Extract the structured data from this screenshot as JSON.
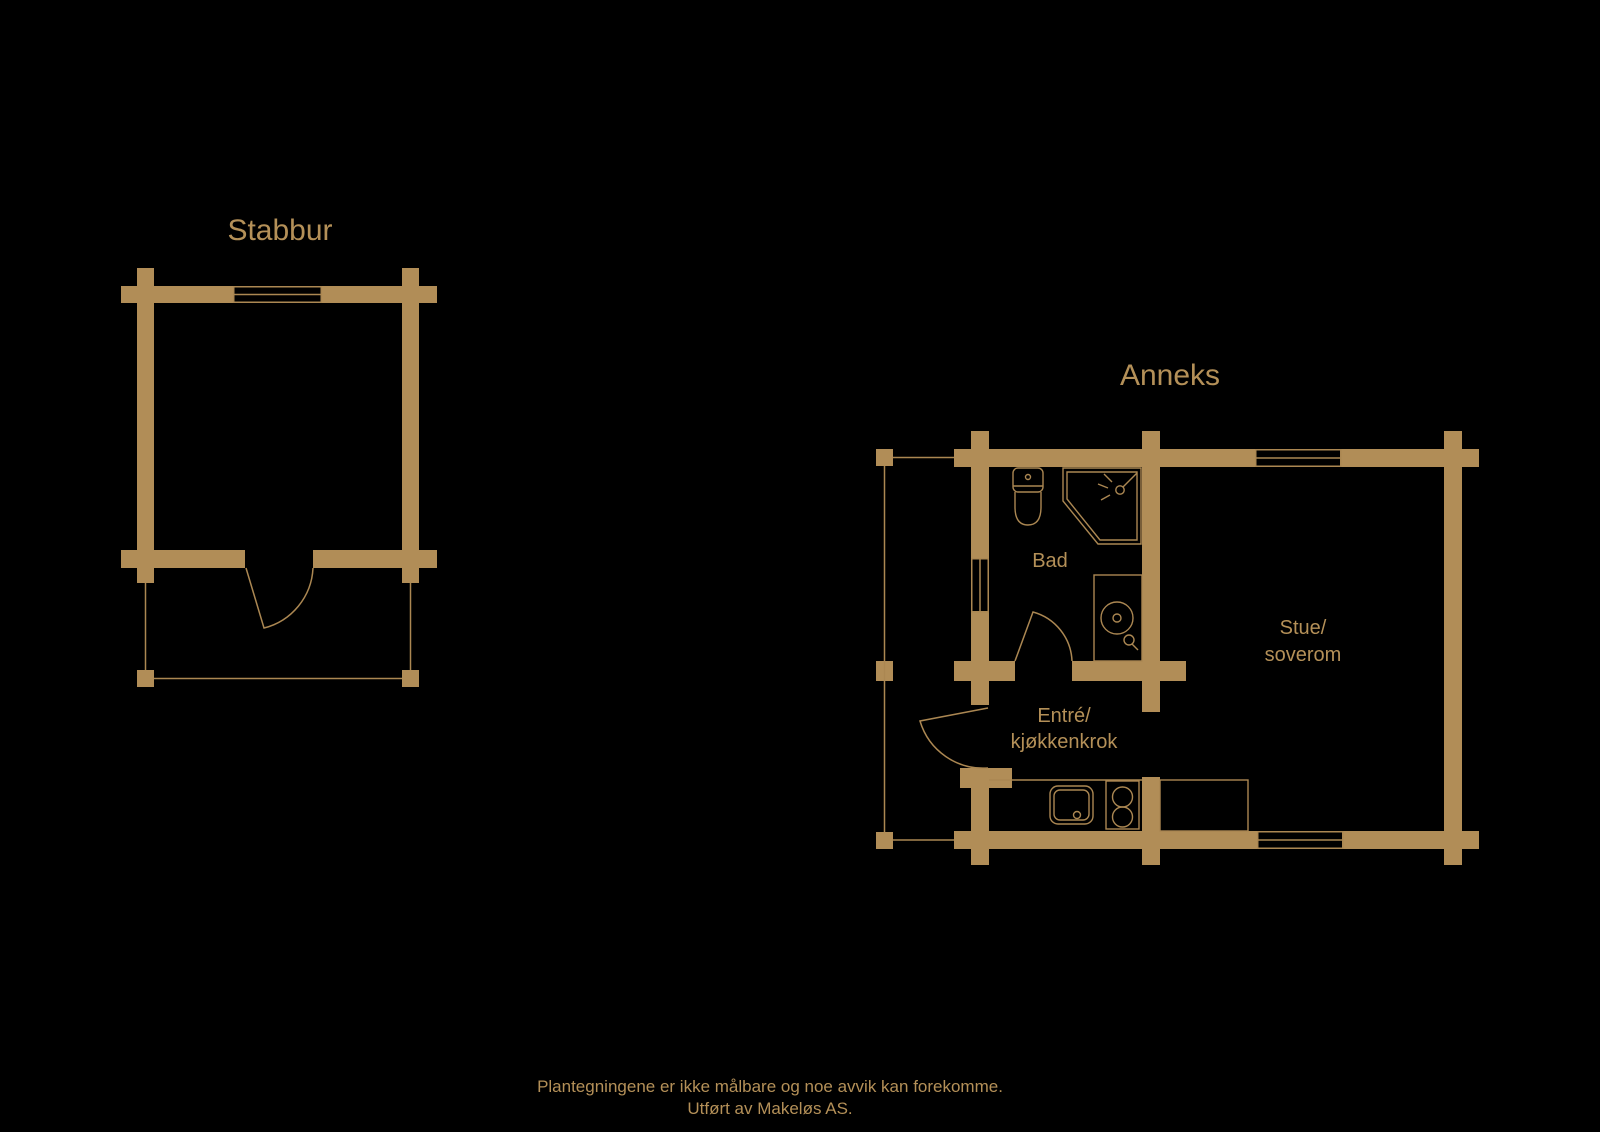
{
  "colors": {
    "background": "#000000",
    "wall": "#b18d57",
    "line": "#ab8752",
    "text": "#b49058"
  },
  "stabbur": {
    "title": "Stabbur"
  },
  "anneks": {
    "title": "Anneks",
    "rooms": {
      "bad": {
        "label": "Bad"
      },
      "entre": {
        "line1": "Entré/",
        "line2": "kjøkkenkrok"
      },
      "stue": {
        "line1": "Stue/",
        "line2": "soverom"
      }
    }
  },
  "icons": {
    "toilet": "toilet",
    "shower": "corner shower",
    "washing_machine": "washing machine",
    "kitchen_sink": "kitchen sink",
    "stove": "two-burner cooktop",
    "counter": "kitchen counter",
    "door": "door swing",
    "window": "window"
  },
  "footer": {
    "line1": "Plantegningene er ikke målbare og noe avvik kan forekomme.",
    "line2": "Utført av Makeløs AS."
  }
}
